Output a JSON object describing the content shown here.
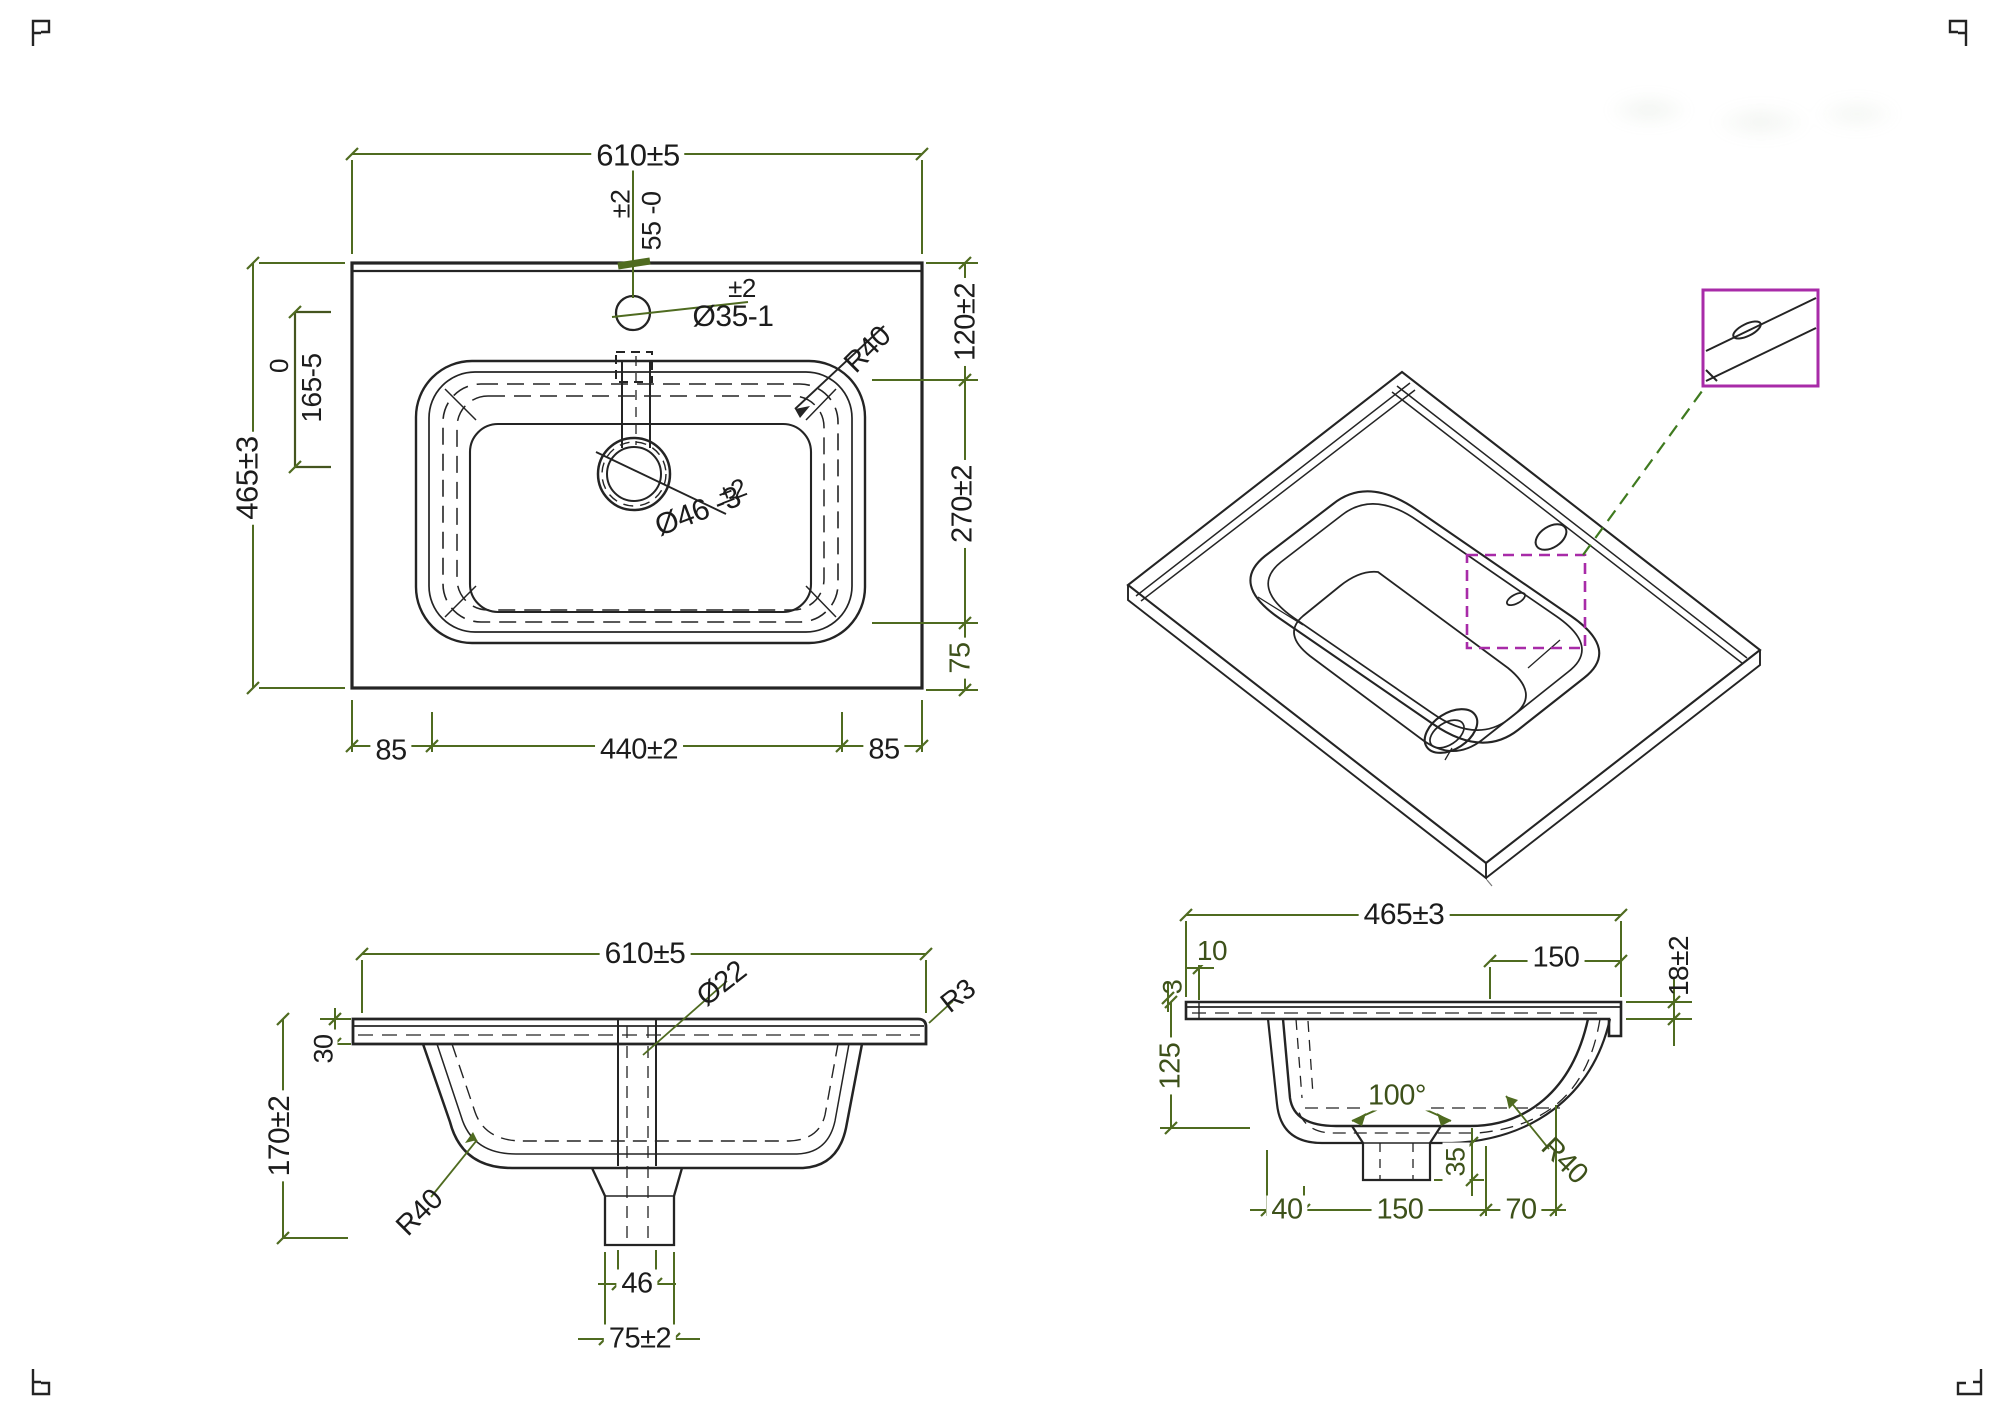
{
  "colors": {
    "paper": "#ffffff",
    "ink": "#242424",
    "dim": "#4f6b20",
    "dimtext": "#1c1c1c",
    "olive": "#3d511a",
    "magenta": "#a82ba8",
    "leader": "#3f7a1f"
  },
  "plan_view": {
    "dim_width": "610±5",
    "faucet_offset_tol": "±2",
    "faucet_offset": "55 -0",
    "faucet_hole_tol": "±2",
    "faucet_hole": "Ø35-1",
    "corner_radius": "R40",
    "dim_height": "465±3",
    "basin_depth_upper": "0",
    "basin_depth": "165-5",
    "dim_right_top": "120±2",
    "dim_right_mid": "270±2",
    "dim_right_bottom": "75",
    "drain_tol": "±2",
    "drain": "Ø46 -3",
    "dim_bottom_left": "85",
    "dim_bottom_center": "440±2",
    "dim_bottom_right": "85"
  },
  "front_view": {
    "dim_width": "610±5",
    "overflow_dia": "Ø22",
    "edge_radius": "R3",
    "slab_thickness": "30",
    "dim_height": "170±2",
    "corner_radius": "R40",
    "drain_inner": "46",
    "drain_outer": "75±2"
  },
  "side_view": {
    "dim_depth": "465±3",
    "back_gap": "10",
    "front_flat": "150",
    "slab_thickness": "18±2",
    "lip": "3",
    "dim_height": "125",
    "basin_angle": "100°",
    "boss_height": "35",
    "corner_radius": "R40",
    "bottom_left": "40",
    "bottom_center": "150",
    "bottom_right": "70"
  }
}
